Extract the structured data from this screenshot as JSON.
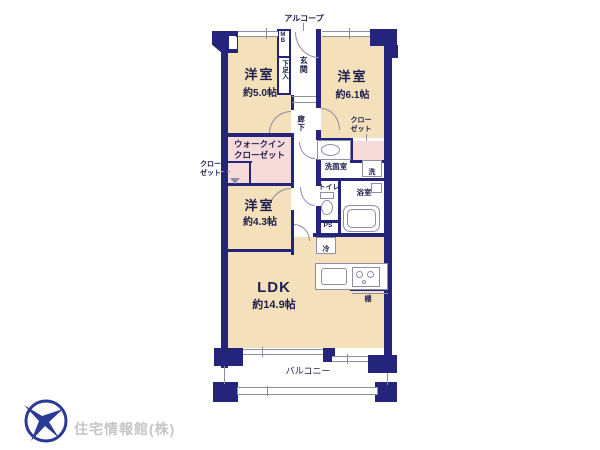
{
  "plan": {
    "alcove": "アルコープ",
    "meter_box": "MB",
    "shoe_cabinet": "下足入",
    "entrance": "玄関",
    "hallway": "廊下",
    "bedroom1": {
      "name": "洋室",
      "size": "約5.0帖"
    },
    "bedroom2": {
      "name": "洋室",
      "size": "約6.1帖"
    },
    "bedroom3": {
      "name": "洋室",
      "size": "約4.3帖"
    },
    "ldk": {
      "name": "LDK",
      "size": "約14.9帖"
    },
    "wic": {
      "line1": "ウォークイン",
      "line2": "クローゼット"
    },
    "closet_left": {
      "line1": "クロー",
      "line2": "ゼット"
    },
    "closet_right": {
      "line1": "クロー",
      "line2": "ゼット"
    },
    "washroom": "洗面室",
    "laundry": "洗",
    "toilet": "トイレ",
    "bathroom": "浴室",
    "pipe_space": "PS",
    "refrigerator": "冷",
    "shelf": "棚",
    "balcony": "バルコニー"
  },
  "logo": {
    "company": "住宅情報館(株)"
  },
  "colors": {
    "wall": "#24247c",
    "room_fill": "#f4e0ba",
    "closet_fill": "#f7dbdb",
    "fixture_line": "#8d8da6",
    "label_text": "#1d1d4e",
    "logo_blue": "#2b3a96",
    "logo_text": "#c6c6c6"
  }
}
